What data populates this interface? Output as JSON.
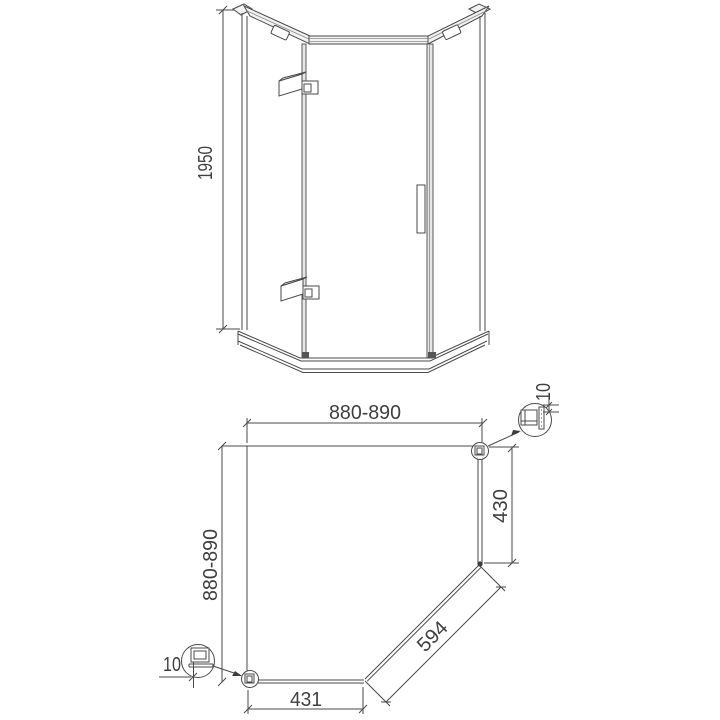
{
  "colors": {
    "background": "#ffffff",
    "line": "#4a4a4a",
    "text": "#3f3f3f"
  },
  "elevation": {
    "height_label": "1950"
  },
  "plan": {
    "top_width_label": "880-890",
    "left_depth_label": "880-890",
    "right_panel_label": "430",
    "door_panel_label": "594",
    "bottom_panel_label": "431",
    "detail_top_right_label": "10",
    "detail_bottom_left_label": "10"
  }
}
